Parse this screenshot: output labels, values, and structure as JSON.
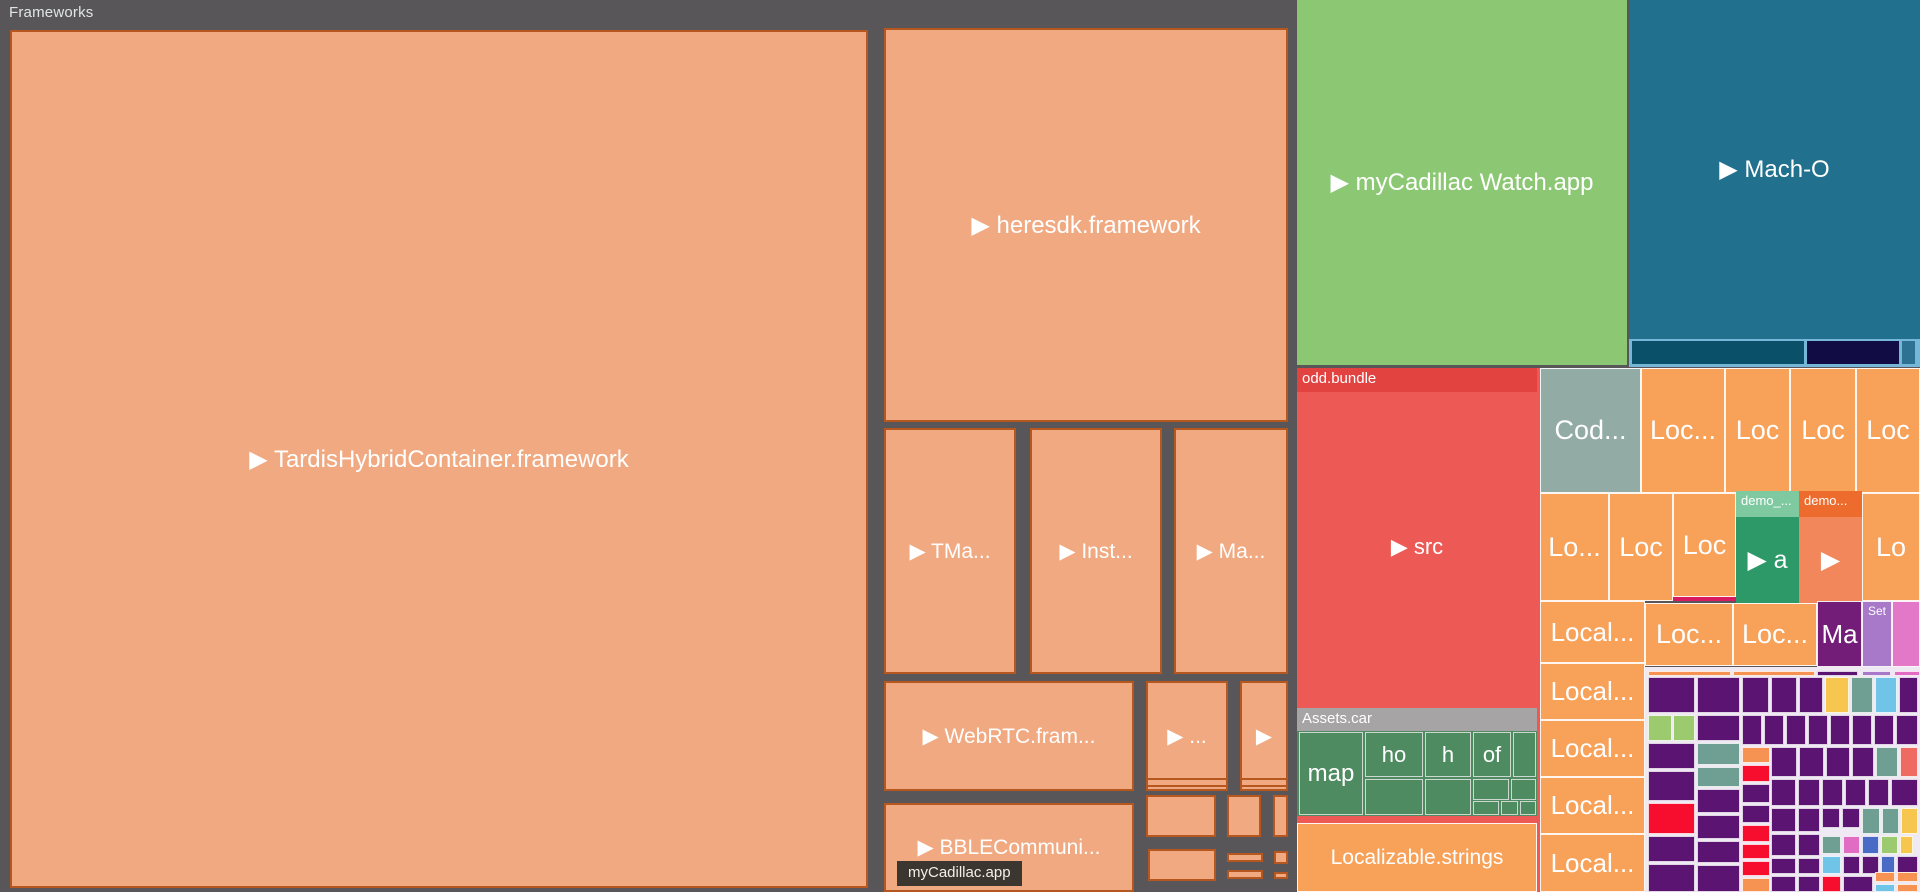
{
  "frameworks_title": "Frameworks",
  "tooltip_label": "myCadillac.app",
  "palette": {
    "bg": "#59565a",
    "fwFill": "#f0a981",
    "fwBorder": "#b5571e",
    "green": "#8cc873",
    "teal": "#21708e",
    "lightblue": "#76b6d9",
    "darkteal": "#0a5068",
    "navy": "#120c45",
    "tealsm": "#2d7290",
    "red": "#ed5a55",
    "redHdr": "#e34340",
    "grayHdr": "#a6a4a4",
    "assetGreen": "#4f8b60",
    "orange": "#f7a159",
    "codGray": "#93aba5",
    "demoGreenHdr": "#7fc9a1",
    "demoGreen": "#2e9968",
    "demoOrangeHdr": "#ed6c2d",
    "demoOrange": "#f1875b",
    "crimson": "#d81b60",
    "maPurple": "#731c78",
    "setPurple": "#a878c9",
    "pinkCell": "#e377c8",
    "mosaicBg": "#efe9f4",
    "P": "#5c1472",
    "R": "#f70d2e",
    "O": "#f79352",
    "Y": "#f6c64f",
    "S": "#6f9e92",
    "K": "#70c4e8",
    "G": "#9bcb6e",
    "B": "#4a6bc5",
    "M": "#e06cc3",
    "C": "#ee6a62",
    "V": "#a878c9"
  },
  "cells": [
    {
      "n": "cell-tardishybridcontainer-framework",
      "l": "▶ TardisHybridContainer.framework",
      "fs": 24,
      "x": 10,
      "y": 30,
      "w": 858,
      "h": 858,
      "f": "fwFill",
      "bd": "fw"
    },
    {
      "n": "cell-heresdk-framework",
      "l": "▶ heresdk.framework",
      "fs": 24,
      "x": 884,
      "y": 28,
      "w": 404,
      "h": 394,
      "f": "fwFill",
      "bd": "fw"
    },
    {
      "n": "cell-tma-framework",
      "l": "▶ TMa...",
      "x": 884,
      "y": 428,
      "w": 132,
      "h": 246,
      "f": "fwFill",
      "bd": "fw"
    },
    {
      "n": "cell-inst-framework",
      "l": "▶ Inst...",
      "x": 1030,
      "y": 428,
      "w": 132,
      "h": 246,
      "f": "fwFill",
      "bd": "fw"
    },
    {
      "n": "cell-ma-framework",
      "l": "▶ Ma...",
      "x": 1174,
      "y": 428,
      "w": 114,
      "h": 246,
      "f": "fwFill",
      "bd": "fw"
    },
    {
      "n": "cell-webrtc-framework",
      "l": "▶ WebRTC.fram...",
      "x": 884,
      "y": 681,
      "w": 250,
      "h": 110,
      "f": "fwFill",
      "bd": "fw"
    },
    {
      "n": "cell-framework-ellipsis",
      "l": "▶ ...",
      "x": 1146,
      "y": 681,
      "w": 82,
      "h": 110,
      "f": "fwFill",
      "bd": "fw"
    },
    {
      "n": "cell-framework-small",
      "l": "▶",
      "x": 1240,
      "y": 681,
      "w": 48,
      "h": 110,
      "f": "fwFill",
      "bd": "fw"
    },
    {
      "n": "cell-bblecommuni-framework",
      "l": "▶ BBLECommuni...",
      "x": 884,
      "y": 803,
      "w": 250,
      "h": 89,
      "f": "fwFill",
      "bd": "fw"
    },
    {
      "x": 1146,
      "y": 778,
      "w": 82,
      "h": 9,
      "f": "fwFill",
      "bd": "fw"
    },
    {
      "x": 1240,
      "y": 778,
      "w": 48,
      "h": 9,
      "f": "fwFill",
      "bd": "fw"
    },
    {
      "x": 1146,
      "y": 795,
      "w": 70,
      "h": 42,
      "f": "fwFill",
      "bd": "fw"
    },
    {
      "x": 1227,
      "y": 795,
      "w": 34,
      "h": 42,
      "f": "fwFill",
      "bd": "fw"
    },
    {
      "x": 1273,
      "y": 795,
      "w": 15,
      "h": 42,
      "f": "fwFill",
      "bd": "fw"
    },
    {
      "x": 1148,
      "y": 849,
      "w": 68,
      "h": 32,
      "f": "fwFill",
      "bd": "fw"
    },
    {
      "x": 1227,
      "y": 853,
      "w": 36,
      "h": 9,
      "f": "fwFill",
      "bd": "fw"
    },
    {
      "x": 1274,
      "y": 851,
      "w": 14,
      "h": 13,
      "f": "fwFill",
      "bd": "fw"
    },
    {
      "x": 1227,
      "y": 870,
      "w": 36,
      "h": 9,
      "f": "fwFill",
      "bd": "fw"
    },
    {
      "x": 1274,
      "y": 872,
      "w": 14,
      "h": 7,
      "f": "fwFill",
      "bd": "fw"
    },
    {
      "n": "cell-mycadillac-watch-app",
      "l": "▶ myCadillac Watch.app",
      "fs": 24,
      "x": 1297,
      "y": 0,
      "w": 330,
      "h": 365,
      "f": "green"
    },
    {
      "n": "cell-mach-o",
      "l": "▶ Mach-O",
      "fs": 24,
      "x": 1629,
      "y": 0,
      "w": 291,
      "h": 339,
      "f": "teal"
    },
    {
      "n": "strip-mach-o",
      "x": 1629,
      "y": 339,
      "w": 291,
      "h": 28,
      "f": "lightblue"
    },
    {
      "n": "cell-mach-o-sub",
      "x": 1632,
      "y": 341,
      "w": 172,
      "h": 23,
      "f": "darkteal"
    },
    {
      "n": "cell-mach-o-sub",
      "x": 1807,
      "y": 341,
      "w": 92,
      "h": 23,
      "f": "navy"
    },
    {
      "n": "cell-mach-o-sub",
      "x": 1902,
      "y": 341,
      "w": 13,
      "h": 23,
      "f": "tealsm"
    },
    {
      "n": "region-mycadillac-app",
      "x": 1297,
      "y": 368,
      "w": 248,
      "h": 524,
      "f": "red"
    },
    {
      "n": "cell-odd-bundle",
      "l": "▶ src",
      "fs": 22,
      "x": 1297,
      "y": 368,
      "w": 240,
      "h": 334,
      "f": "red",
      "hd": {
        "l": "odd.bundle",
        "f": "redHdr",
        "h": 24,
        "fs": 15
      }
    },
    {
      "n": "cell-assets-car",
      "x": 1297,
      "y": 708,
      "w": 240,
      "h": 108,
      "f": "assetGreen",
      "hd": {
        "l": "Assets.car",
        "f": "grayHdr",
        "h": 23,
        "fs": 15
      }
    },
    {
      "n": "cell-assets-map",
      "l": "map",
      "fs": 24,
      "x": 1299,
      "y": 732,
      "w": 64,
      "h": 83,
      "f": "assetGreen",
      "bd": "as"
    },
    {
      "n": "cell-assets-ho",
      "l": "ho",
      "fs": 22,
      "x": 1365,
      "y": 732,
      "w": 58,
      "h": 45,
      "f": "assetGreen",
      "bd": "as"
    },
    {
      "n": "cell-assets-h",
      "l": "h",
      "fs": 22,
      "x": 1425,
      "y": 732,
      "w": 46,
      "h": 45,
      "f": "assetGreen",
      "bd": "as"
    },
    {
      "n": "cell-assets-of",
      "l": "of",
      "fs": 22,
      "x": 1473,
      "y": 732,
      "w": 38,
      "h": 45,
      "f": "assetGreen",
      "bd": "as"
    },
    {
      "x": 1513,
      "y": 732,
      "w": 23,
      "h": 45,
      "f": "assetGreen",
      "bd": "as"
    },
    {
      "x": 1365,
      "y": 779,
      "w": 58,
      "h": 36,
      "f": "assetGreen",
      "bd": "as"
    },
    {
      "x": 1425,
      "y": 779,
      "w": 46,
      "h": 36,
      "f": "assetGreen",
      "bd": "as"
    },
    {
      "x": 1473,
      "y": 779,
      "w": 36,
      "h": 21,
      "f": "assetGreen",
      "bd": "as"
    },
    {
      "x": 1511,
      "y": 779,
      "w": 25,
      "h": 21,
      "f": "assetGreen",
      "bd": "as"
    },
    {
      "x": 1473,
      "y": 801,
      "w": 26,
      "h": 14,
      "f": "assetGreen",
      "bd": "as"
    },
    {
      "x": 1501,
      "y": 801,
      "w": 17,
      "h": 14,
      "f": "assetGreen",
      "bd": "as"
    },
    {
      "x": 1520,
      "y": 801,
      "w": 16,
      "h": 14,
      "f": "assetGreen",
      "bd": "as"
    },
    {
      "n": "cell-localizable-strings",
      "l": "Localizable.strings",
      "fs": 21,
      "x": 1297,
      "y": 823,
      "w": 240,
      "h": 69,
      "f": "orange",
      "bd": "wh"
    },
    {
      "n": "cell-cod",
      "l": "Cod...",
      "fs": 27,
      "x": 1540,
      "y": 368,
      "w": 101,
      "h": 125,
      "f": "codGray",
      "bd": "wh"
    },
    {
      "n": "cell-loc",
      "l": "Loc...",
      "fs": 27,
      "x": 1641,
      "y": 368,
      "w": 84,
      "h": 125,
      "f": "orange",
      "bd": "wh"
    },
    {
      "n": "cell-loc",
      "l": "Loc",
      "fs": 27,
      "x": 1725,
      "y": 368,
      "w": 65,
      "h": 125,
      "f": "orange",
      "bd": "wh"
    },
    {
      "n": "cell-loc",
      "l": "Loc",
      "fs": 27,
      "x": 1790,
      "y": 368,
      "w": 66,
      "h": 125,
      "f": "orange",
      "bd": "wh"
    },
    {
      "n": "cell-loc",
      "l": "Loc",
      "fs": 27,
      "x": 1856,
      "y": 368,
      "w": 64,
      "h": 125,
      "f": "orange",
      "bd": "wh"
    },
    {
      "n": "cell-loc",
      "l": "Lo...",
      "fs": 27,
      "x": 1540,
      "y": 493,
      "w": 69,
      "h": 108,
      "f": "orange",
      "bd": "wh"
    },
    {
      "n": "cell-loc",
      "l": "Loc",
      "fs": 27,
      "x": 1609,
      "y": 493,
      "w": 64,
      "h": 108,
      "f": "orange",
      "bd": "wh"
    },
    {
      "n": "cell-loc",
      "l": "Loc",
      "fs": 27,
      "x": 1673,
      "y": 493,
      "w": 63,
      "h": 104,
      "f": "orange",
      "bd": "wh"
    },
    {
      "n": "cell-crimson-bar",
      "x": 1673,
      "y": 597,
      "w": 63,
      "h": 4,
      "f": "crimson"
    },
    {
      "n": "cell-demo-a",
      "l": "▶ a",
      "fs": 25,
      "x": 1736,
      "y": 491,
      "w": 63,
      "h": 112,
      "f": "demoGreen",
      "hd": {
        "l": "demo_...",
        "f": "demoGreenHdr",
        "h": 26,
        "fs": 13
      }
    },
    {
      "n": "cell-demo-b",
      "l": "▶",
      "fs": 25,
      "x": 1799,
      "y": 491,
      "w": 63,
      "h": 112,
      "f": "demoOrange",
      "hd": {
        "l": "demo...",
        "f": "demoOrangeHdr",
        "h": 26,
        "fs": 13
      }
    },
    {
      "n": "cell-loc",
      "l": "Lo",
      "fs": 27,
      "x": 1862,
      "y": 493,
      "w": 58,
      "h": 108,
      "f": "orange",
      "bd": "wh"
    },
    {
      "n": "cell-local",
      "l": "Local...",
      "fs": 26,
      "x": 1540,
      "y": 601,
      "w": 105,
      "h": 62,
      "f": "orange",
      "bd": "wh"
    },
    {
      "n": "cell-loc",
      "l": "Loc...",
      "fs": 27,
      "x": 1645,
      "y": 603,
      "w": 88,
      "h": 63,
      "f": "orange",
      "bd": "wh"
    },
    {
      "n": "cell-loc",
      "l": "Loc...",
      "fs": 27,
      "x": 1733,
      "y": 603,
      "w": 84,
      "h": 63,
      "f": "orange",
      "bd": "wh"
    },
    {
      "n": "cell-ma-purple",
      "l": "Ma",
      "fs": 26,
      "x": 1817,
      "y": 601,
      "w": 45,
      "h": 66,
      "f": "maPurple",
      "bd": "wh"
    },
    {
      "n": "cell-set",
      "x": 1862,
      "y": 601,
      "w": 30,
      "h": 66,
      "f": "setPurple",
      "bd": "wh",
      "hd": {
        "l": "Set",
        "f": "setPurple",
        "h": 18,
        "fs": 12
      }
    },
    {
      "n": "cell-pink",
      "x": 1892,
      "y": 601,
      "w": 28,
      "h": 66,
      "f": "pinkCell",
      "bd": "wh"
    },
    {
      "n": "cell-local",
      "l": "Local...",
      "fs": 26,
      "x": 1540,
      "y": 663,
      "w": 105,
      "h": 57,
      "f": "orange",
      "bd": "wh"
    },
    {
      "n": "cell-local",
      "l": "Local...",
      "fs": 26,
      "x": 1540,
      "y": 720,
      "w": 105,
      "h": 57,
      "f": "orange",
      "bd": "wh"
    },
    {
      "n": "cell-local",
      "l": "Local...",
      "fs": 26,
      "x": 1540,
      "y": 777,
      "w": 105,
      "h": 57,
      "f": "orange",
      "bd": "wh"
    },
    {
      "n": "cell-local",
      "l": "Local...",
      "fs": 26,
      "x": 1540,
      "y": 834,
      "w": 105,
      "h": 58,
      "f": "orange",
      "bd": "wh"
    },
    {
      "n": "region-mosaic-bg",
      "x": 1645,
      "y": 667,
      "w": 275,
      "h": 225,
      "f": "mosaicBg"
    }
  ],
  "mosaic": [
    [
      1648,
      671,
      83,
      5,
      "O"
    ],
    [
      1733,
      671,
      82,
      5,
      "O"
    ],
    [
      1817,
      671,
      41,
      5,
      "P"
    ],
    [
      1862,
      671,
      29,
      5,
      "V"
    ],
    [
      1894,
      671,
      26,
      5,
      "M"
    ],
    [
      1648,
      677,
      47,
      36,
      "P"
    ],
    [
      1697,
      677,
      43,
      36,
      "P"
    ],
    [
      1742,
      677,
      27,
      36,
      "P"
    ],
    [
      1771,
      677,
      26,
      36,
      "P"
    ],
    [
      1799,
      677,
      24,
      36,
      "P"
    ],
    [
      1825,
      677,
      24,
      36,
      "Y"
    ],
    [
      1851,
      677,
      22,
      36,
      "S"
    ],
    [
      1875,
      677,
      22,
      36,
      "K",
      "dots"
    ],
    [
      1899,
      677,
      19,
      36,
      "P"
    ],
    [
      1648,
      715,
      24,
      26,
      "G"
    ],
    [
      1673,
      715,
      22,
      26,
      "G"
    ],
    [
      1697,
      715,
      43,
      26,
      "P"
    ],
    [
      1742,
      715,
      20,
      30,
      "P"
    ],
    [
      1764,
      715,
      20,
      30,
      "P"
    ],
    [
      1786,
      715,
      20,
      30,
      "P"
    ],
    [
      1808,
      715,
      20,
      30,
      "P"
    ],
    [
      1830,
      715,
      20,
      30,
      "P"
    ],
    [
      1852,
      715,
      20,
      30,
      "P"
    ],
    [
      1874,
      715,
      20,
      30,
      "P"
    ],
    [
      1896,
      715,
      22,
      30,
      "P"
    ],
    [
      1648,
      743,
      47,
      26,
      "P"
    ],
    [
      1697,
      743,
      43,
      22,
      "S"
    ],
    [
      1697,
      767,
      43,
      20,
      "S"
    ],
    [
      1742,
      747,
      28,
      16,
      "O"
    ],
    [
      1742,
      765,
      28,
      17,
      "R"
    ],
    [
      1771,
      747,
      26,
      30,
      "P"
    ],
    [
      1799,
      747,
      25,
      30,
      "P"
    ],
    [
      1826,
      747,
      24,
      30,
      "P"
    ],
    [
      1852,
      747,
      22,
      30,
      "P"
    ],
    [
      1876,
      747,
      22,
      30,
      "S"
    ],
    [
      1900,
      747,
      18,
      30,
      "C"
    ],
    [
      1648,
      771,
      47,
      30,
      "P"
    ],
    [
      1697,
      789,
      43,
      24,
      "P"
    ],
    [
      1742,
      784,
      28,
      19,
      "P"
    ],
    [
      1771,
      779,
      25,
      27,
      "P"
    ],
    [
      1798,
      779,
      22,
      27,
      "P"
    ],
    [
      1822,
      779,
      21,
      27,
      "P"
    ],
    [
      1845,
      779,
      21,
      27,
      "P"
    ],
    [
      1868,
      779,
      21,
      27,
      "P"
    ],
    [
      1891,
      779,
      27,
      27,
      "P"
    ],
    [
      1648,
      803,
      47,
      31,
      "R"
    ],
    [
      1697,
      815,
      43,
      24,
      "P"
    ],
    [
      1742,
      805,
      28,
      18,
      "P"
    ],
    [
      1771,
      808,
      25,
      24,
      "P"
    ],
    [
      1798,
      808,
      22,
      24,
      "P"
    ],
    [
      1822,
      808,
      18,
      20,
      "P"
    ],
    [
      1842,
      808,
      18,
      20,
      "P"
    ],
    [
      1862,
      808,
      18,
      26,
      "S"
    ],
    [
      1882,
      808,
      17,
      26,
      "S"
    ],
    [
      1901,
      808,
      17,
      26,
      "Y"
    ],
    [
      1648,
      836,
      47,
      26,
      "P"
    ],
    [
      1697,
      841,
      43,
      22,
      "P"
    ],
    [
      1742,
      825,
      28,
      17,
      "R"
    ],
    [
      1742,
      844,
      28,
      15,
      "R"
    ],
    [
      1771,
      834,
      25,
      22,
      "P"
    ],
    [
      1798,
      834,
      22,
      22,
      "P"
    ],
    [
      1822,
      836,
      19,
      18,
      "S"
    ],
    [
      1843,
      836,
      17,
      18,
      "M"
    ],
    [
      1862,
      836,
      17,
      18,
      "B"
    ],
    [
      1881,
      836,
      17,
      18,
      "G"
    ],
    [
      1900,
      836,
      13,
      18,
      "Y"
    ],
    [
      1822,
      856,
      19,
      18,
      "K",
      "dots"
    ],
    [
      1843,
      856,
      17,
      18,
      "P"
    ],
    [
      1862,
      856,
      17,
      18,
      "P"
    ],
    [
      1881,
      856,
      14,
      18,
      "B"
    ],
    [
      1897,
      856,
      21,
      18,
      "P"
    ],
    [
      1648,
      864,
      47,
      28,
      "P"
    ],
    [
      1697,
      865,
      43,
      27,
      "P"
    ],
    [
      1742,
      861,
      28,
      15,
      "R"
    ],
    [
      1742,
      878,
      28,
      14,
      "O"
    ],
    [
      1771,
      858,
      25,
      16,
      "P"
    ],
    [
      1798,
      858,
      22,
      16,
      "P"
    ],
    [
      1771,
      876,
      25,
      16,
      "P"
    ],
    [
      1798,
      876,
      22,
      16,
      "P"
    ],
    [
      1822,
      876,
      19,
      16,
      "R"
    ],
    [
      1843,
      876,
      30,
      16,
      "P"
    ],
    [
      1875,
      872,
      20,
      10,
      "O"
    ],
    [
      1897,
      872,
      21,
      10,
      "O"
    ],
    [
      1875,
      884,
      20,
      8,
      "K",
      "dots"
    ],
    [
      1897,
      884,
      21,
      8,
      "O"
    ]
  ]
}
